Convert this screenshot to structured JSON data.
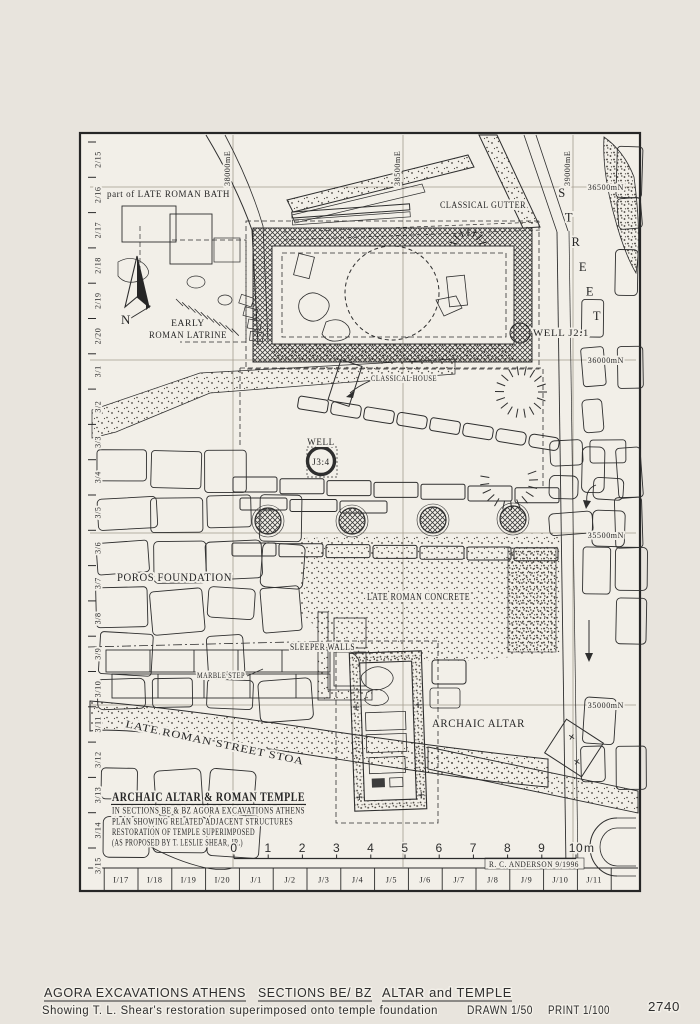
{
  "plan": {
    "feature_labels": {
      "late_roman_bath": "part of LATE ROMAN BATH",
      "classical_gutter": "CLASSICAL GUTTER",
      "early_roman_latrine_1": "EARLY",
      "early_roman_latrine_2": "ROMAN LATRINE",
      "well_j21": "WELL  J2:1",
      "classical_house": "CLASSICAL HOUSE",
      "well_word": "WELL",
      "well_j34": "J3:4",
      "poros_foundation": "POROS  FOUNDATION",
      "late_roman_concrete": "LATE ROMAN CONCRETE",
      "sleeper_walls": "SLEEPER WALLS",
      "marble_step": "MARBLE STEP",
      "archaic_altar": "ARCHAIC ALTAR",
      "late_roman_street_stoa": "LATE  ROMAN  STREET  STOA",
      "north": "N"
    },
    "street_label": "STREET",
    "title_block": {
      "title": "ARCHAIC ALTAR & ROMAN TEMPLE",
      "line1": "IN SECTIONS  BE & BZ    AGORA EXCAVATIONS ATHENS",
      "line2": "PLAN SHOWING RELATED ADJACENT STRUCTURES",
      "line3": "RESTORATION OF TEMPLE SUPERIMPOSED",
      "line4": "(AS PROPOSED BY T. LESLIE SHEAR, JR.)"
    },
    "credit": "R. C. ANDERSON  9/1996",
    "grid": {
      "row_labels": [
        "2/15",
        "2/16",
        "2/17",
        "2/18",
        "2/19",
        "2/20",
        "3/1",
        "3/2",
        "3/3",
        "3/4",
        "3/5",
        "3/6",
        "3/7",
        "3/8",
        "3/9",
        "3/10",
        "3/11",
        "3/12",
        "3/13",
        "3/14",
        "3/15"
      ],
      "column_labels": [
        "I/17",
        "I/18",
        "I/19",
        "I/20",
        "J/1",
        "J/2",
        "J/3",
        "J/4",
        "J/5",
        "J/6",
        "J/7",
        "J/8",
        "J/9",
        "J/10",
        "J/11"
      ],
      "easting_labels": [
        "38000mE",
        "38500mE",
        "39000mE"
      ],
      "northing_labels": [
        "36500mN",
        "36000mN",
        "35500mN",
        "35000mN"
      ]
    },
    "scale_bar": {
      "numbers": [
        "0",
        "1",
        "2",
        "3",
        "4",
        "5",
        "6",
        "7",
        "8",
        "9",
        "10"
      ],
      "unit": "m"
    }
  },
  "caption": {
    "title_segments": [
      "AGORA EXCAVATIONS ATHENS",
      "SECTIONS BE/ BZ",
      "ALTAR and TEMPLE"
    ],
    "subtitle": "Showing  T. L. Shear's  restoration  superimposed  onto  temple  foundation",
    "drawn": "DRAWN 1/50",
    "print": "PRINT 1/100",
    "number": "2740"
  },
  "colors": {
    "page": "#e8e4dd",
    "paper": "#f2efe8",
    "ink": "#262626",
    "grid": "#a39c8f",
    "cap": "#2e2e2e"
  }
}
